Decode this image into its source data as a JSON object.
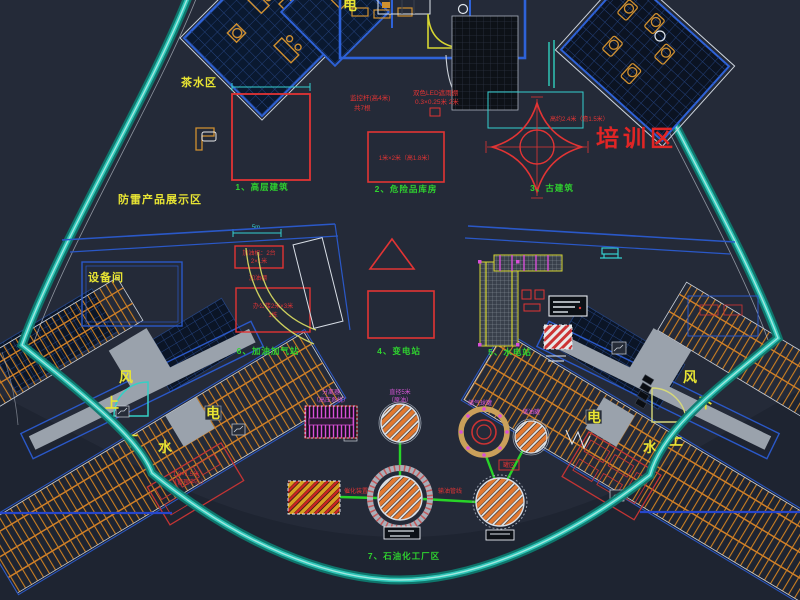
{
  "watermark": {
    "company": "长沙辉浩模型制造厂",
    "website": "www.hhmx123.com",
    "phone": "电话:13975878997（微信）"
  },
  "zones": {
    "tea": "茶水区",
    "display": "防雷产品展示区",
    "equipment": "设备间",
    "training": "培训区"
  },
  "items": {
    "building": {
      "label": "1、高层建筑"
    },
    "hazmat": {
      "label": "2、危险品库房",
      "note": "1米×2米（高1.8米）"
    },
    "ancient": {
      "label": "3、古建筑",
      "note": "高约2.4米（檐1.5米）"
    },
    "substation": {
      "label": "4、变电站"
    },
    "hydro": {
      "label": "5、水电站"
    },
    "gas": {
      "label": "6、加油加气站",
      "note1": "加油机：2台",
      "note2": "2×1米",
      "note3": "加油棚",
      "note4": "办公楼2米×3米",
      "note5": "1栋"
    },
    "petro": {
      "label": "7、石油化工厂区"
    }
  },
  "annotations": {
    "monitor1": "监控杆(高4米)",
    "monitor2": "共7根",
    "canopy1": "双色LED遮雨棚",
    "canopy2": "0.3×0.25米 2米",
    "dim": "5m"
  },
  "plant": {
    "tank_dia1": "直径5米",
    "tank_dia2": "（原油）",
    "separator1": "分离器",
    "separator2": "（高压系统）",
    "sphere": "储气球罐",
    "oil_tank": "储油罐",
    "tank_zone": "罐区",
    "pipe_left": "催化装置",
    "pipe_right": "输油管线",
    "mgmt1": "1.8×1.5米",
    "mgmt2": "（管理中心）"
  },
  "wings": {
    "wind": "风",
    "up": "上",
    "down": "下",
    "water": "水",
    "power": "电"
  }
}
